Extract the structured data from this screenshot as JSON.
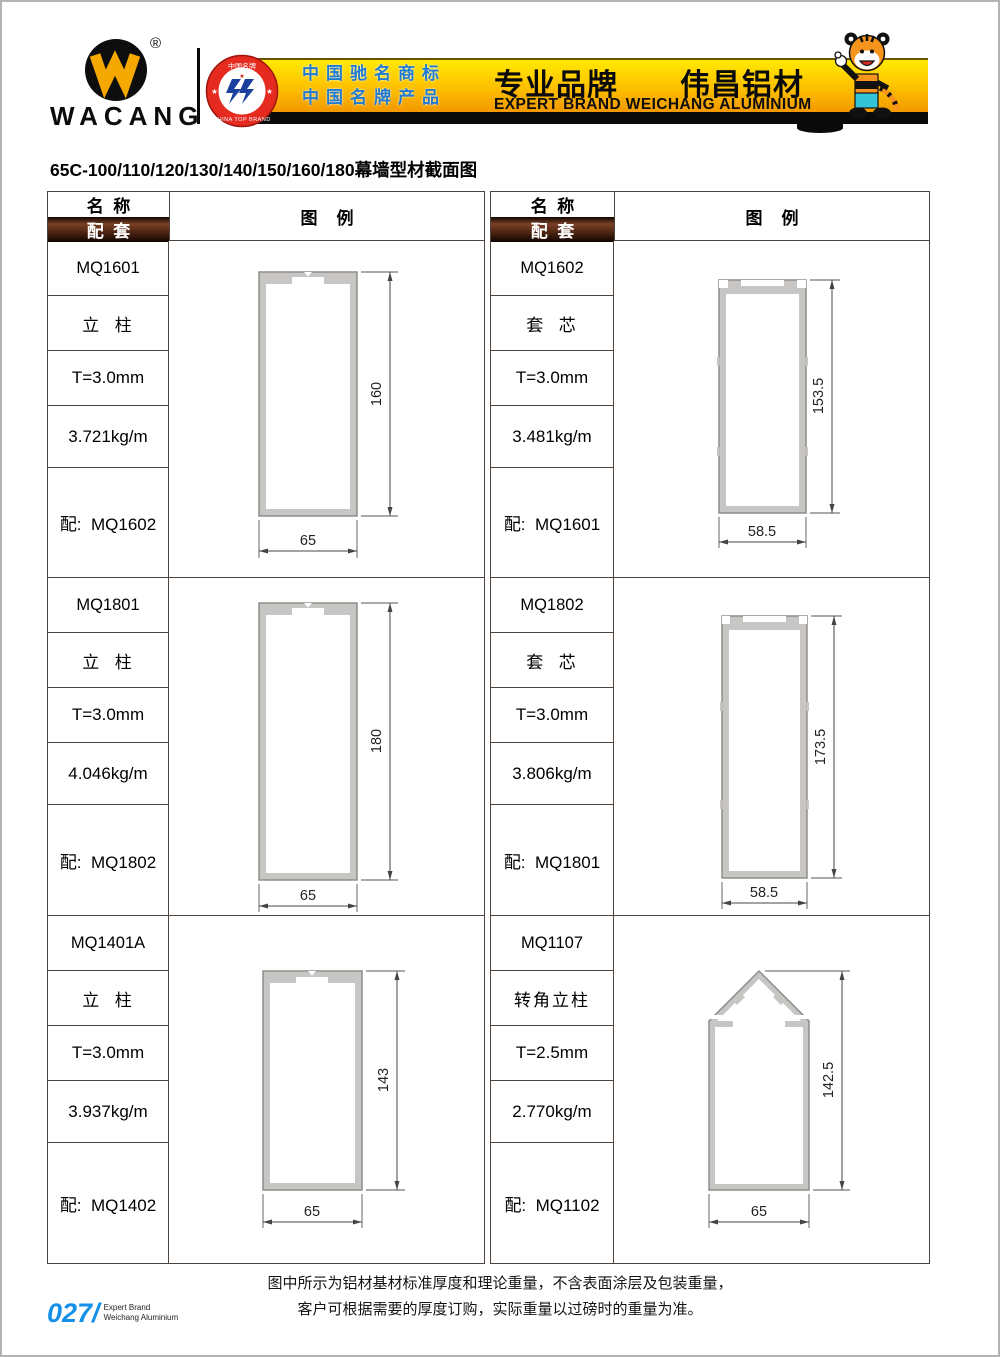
{
  "header": {
    "brand": "WACANG",
    "registered_mark": "®",
    "badge": {
      "top_text": "中国名牌",
      "bottom_text": "CHINA TOP BRAND",
      "star_left": "★",
      "star_right": "★"
    },
    "banner": {
      "blue_line1": "中国驰名商标",
      "blue_line2": "中国名牌产品",
      "title": "专业品牌　　伟昌铝材",
      "subtitle": "EXPERT BRAND WEICHANG ALUMINIUM"
    }
  },
  "page_title": "65C-100/110/120/130/140/150/160/180幕墙型材截面图",
  "table_headers": {
    "name": "名  称",
    "match": "配  套",
    "legend": "图    例"
  },
  "profiles": [
    {
      "code": "MQ1601",
      "type": "立  柱",
      "thickness": "T=3.0mm",
      "weight": "3.721kg/m",
      "match": "配:  MQ1602",
      "width": "65",
      "height": "160"
    },
    {
      "code": "MQ1602",
      "type": "套  芯",
      "thickness": "T=3.0mm",
      "weight": "3.481kg/m",
      "match": "配:  MQ1601",
      "width": "58.5",
      "height": "153.5"
    },
    {
      "code": "MQ1801",
      "type": "立  柱",
      "thickness": "T=3.0mm",
      "weight": "4.046kg/m",
      "match": "配:  MQ1802",
      "width": "65",
      "height": "180"
    },
    {
      "code": "MQ1802",
      "type": "套  芯",
      "thickness": "T=3.0mm",
      "weight": "3.806kg/m",
      "match": "配:  MQ1801",
      "width": "58.5",
      "height": "173.5"
    },
    {
      "code": "MQ1401A",
      "type": "立  柱",
      "thickness": "T=3.0mm",
      "weight": "3.937kg/m",
      "match": "配:  MQ1402",
      "width": "65",
      "height": "143"
    },
    {
      "code": "MQ1107",
      "type": "转角立柱",
      "thickness": "T=2.5mm",
      "weight": "2.770kg/m",
      "match": "配:  MQ1102",
      "width": "65",
      "height": "142.5"
    }
  ],
  "footer": {
    "note1": "图中所示为铝材基材标准厚度和理论重量，不含表面涂层及包装重量，",
    "note2": "客户可根据需要的厚度订购，实际重量以过磅时的重量为准。",
    "page_number": "027/",
    "page_label1": "Expert Brand",
    "page_label2": "Weichang Aluminium"
  },
  "colors": {
    "accent_gold": "#ffc800",
    "accent_blue": "#1f7ad0",
    "band_brown": "#47200f",
    "page_number_blue": "#1590e8",
    "profile_fill": "#c7c6c4"
  }
}
